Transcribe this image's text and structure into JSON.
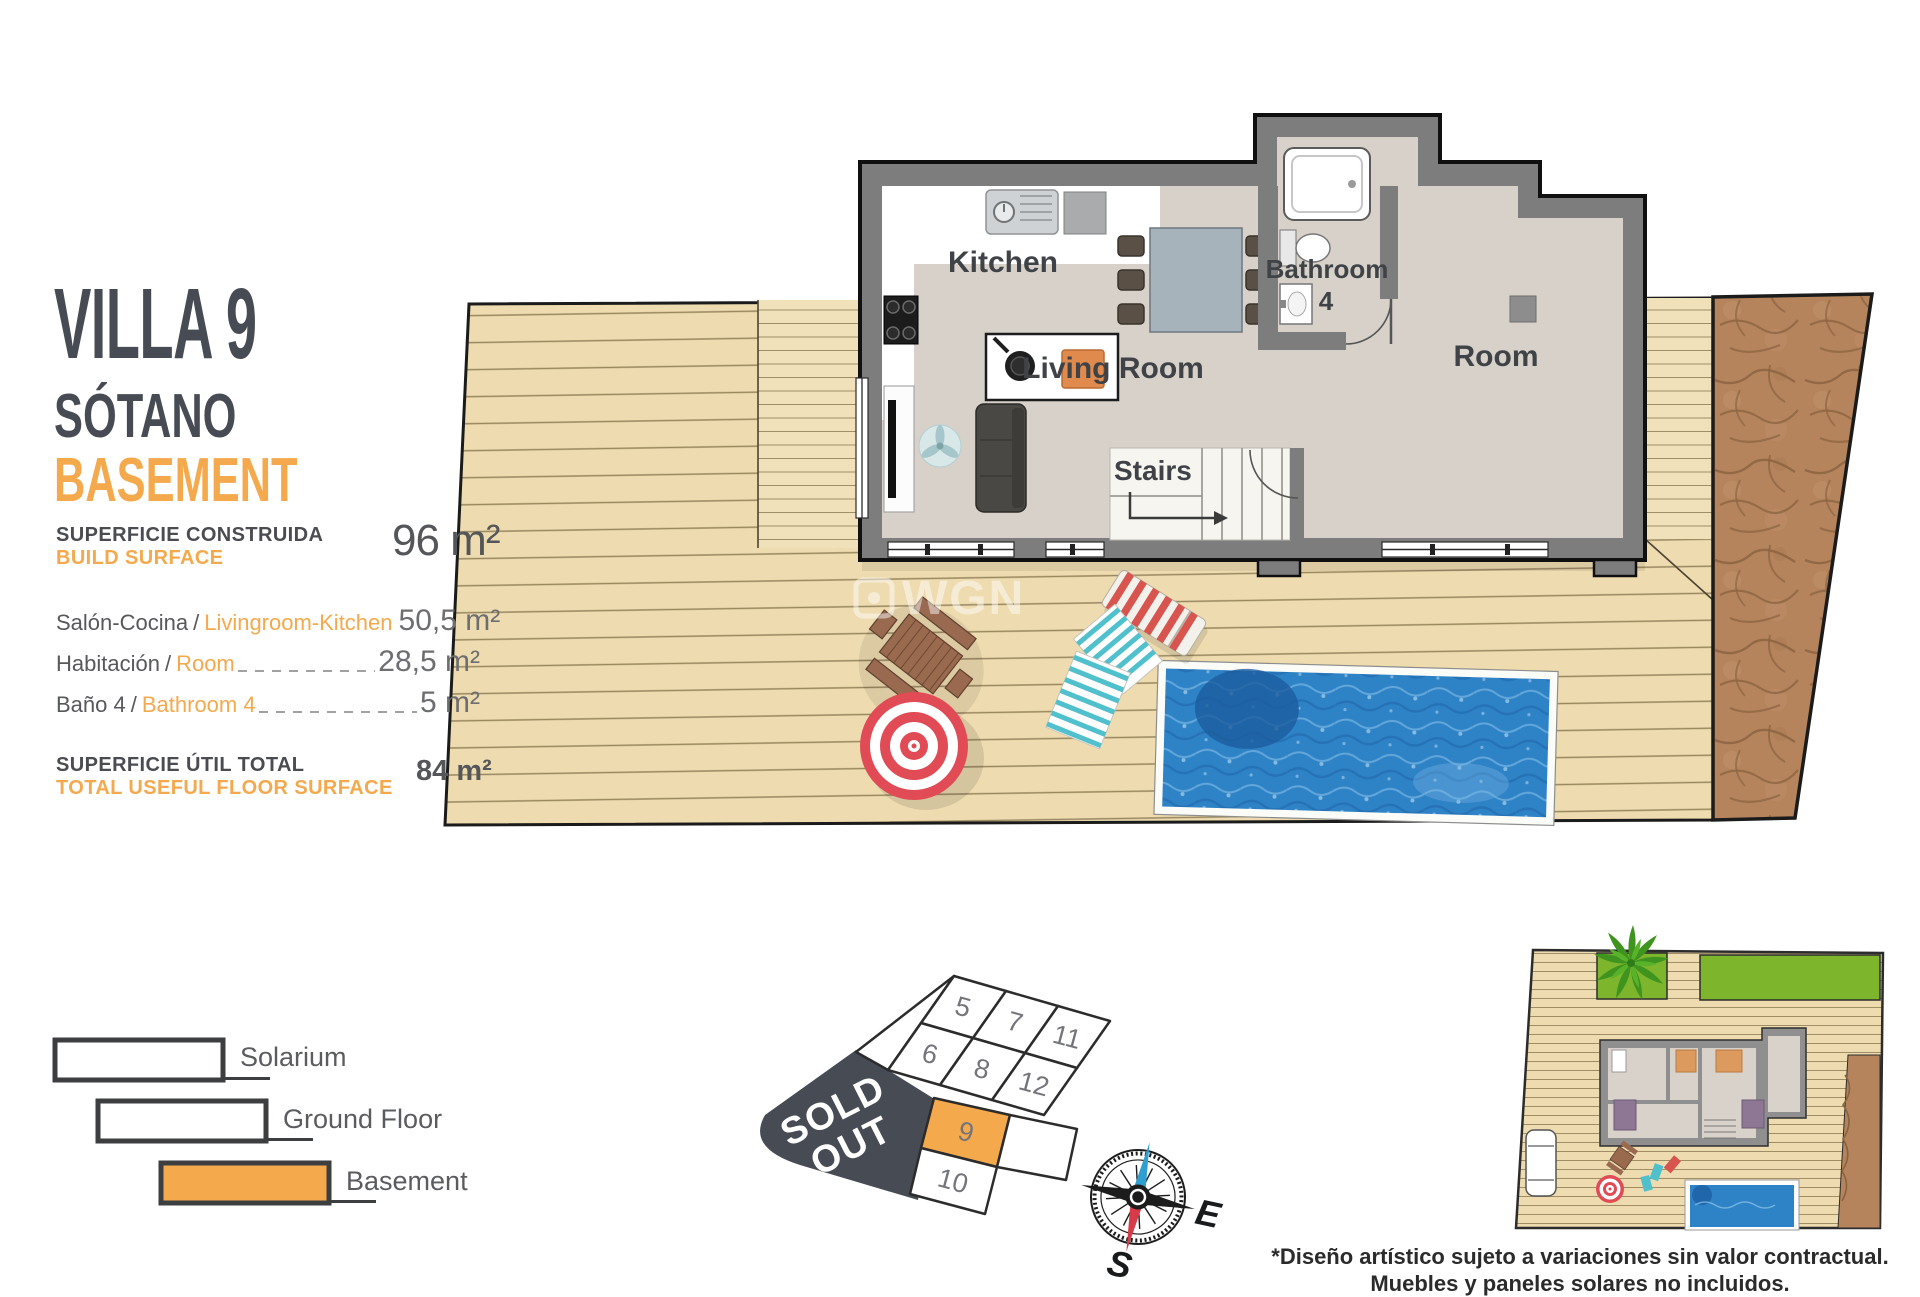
{
  "colors": {
    "accent": "#f5a94d",
    "slate": "#474b54",
    "deck": "#eedcb0",
    "dirt": "#b5845c",
    "pool": "#2e82c6",
    "wall": "#7d7d7d",
    "floor": "#d7d1ca",
    "highlight_plot": "#f5a94d"
  },
  "sep": "/",
  "panel": {
    "title": "VILLA 9",
    "subtitle_es": "SÓTANO",
    "subtitle_en": "BASEMENT",
    "build_surface": {
      "label_es": "SUPERFICIE CONSTRUIDA",
      "label_en": "BUILD SURFACE",
      "value": "96 m²"
    },
    "rooms": [
      {
        "es": "Salón-Cocina",
        "en": "Livingroom-Kitchen",
        "value": "50,5 m²"
      },
      {
        "es": "Habitación",
        "en": "Room",
        "value": "28,5 m²"
      },
      {
        "es": "Baño 4",
        "en": "Bathroom 4",
        "value": "5 m²"
      }
    ],
    "total": {
      "label_es": "SUPERFICIE ÚTIL TOTAL",
      "label_en": "TOTAL USEFUL FLOOR SURFACE",
      "value": "84 m²"
    }
  },
  "legend": {
    "items": [
      {
        "label": "Solarium",
        "fill": "#ffffff"
      },
      {
        "label": "Ground Floor",
        "fill": "#ffffff"
      },
      {
        "label": "Basement",
        "fill": "#f5a94d"
      }
    ]
  },
  "floorplan": {
    "labels": {
      "kitchen": "Kitchen",
      "living_room": "Living Room",
      "bathroom": "Bathroom",
      "bathroom_number": "4",
      "room": "Room",
      "stairs": "Stairs"
    }
  },
  "watermark": "WGN",
  "plot_map": {
    "sold_out_line1": "SOLD",
    "sold_out_line2": "OUT",
    "plots": [
      {
        "number": "5"
      },
      {
        "number": "7"
      },
      {
        "number": "11"
      },
      {
        "number": "6"
      },
      {
        "number": "8"
      },
      {
        "number": "12"
      },
      {
        "number": "9"
      },
      {
        "number": "10"
      }
    ]
  },
  "compass": {
    "east": "E",
    "south": "S"
  },
  "disclaimer": {
    "line1": "*Diseño artístico sujeto a variaciones sin valor contractual.",
    "line2": "Muebles y paneles solares no incluidos."
  }
}
